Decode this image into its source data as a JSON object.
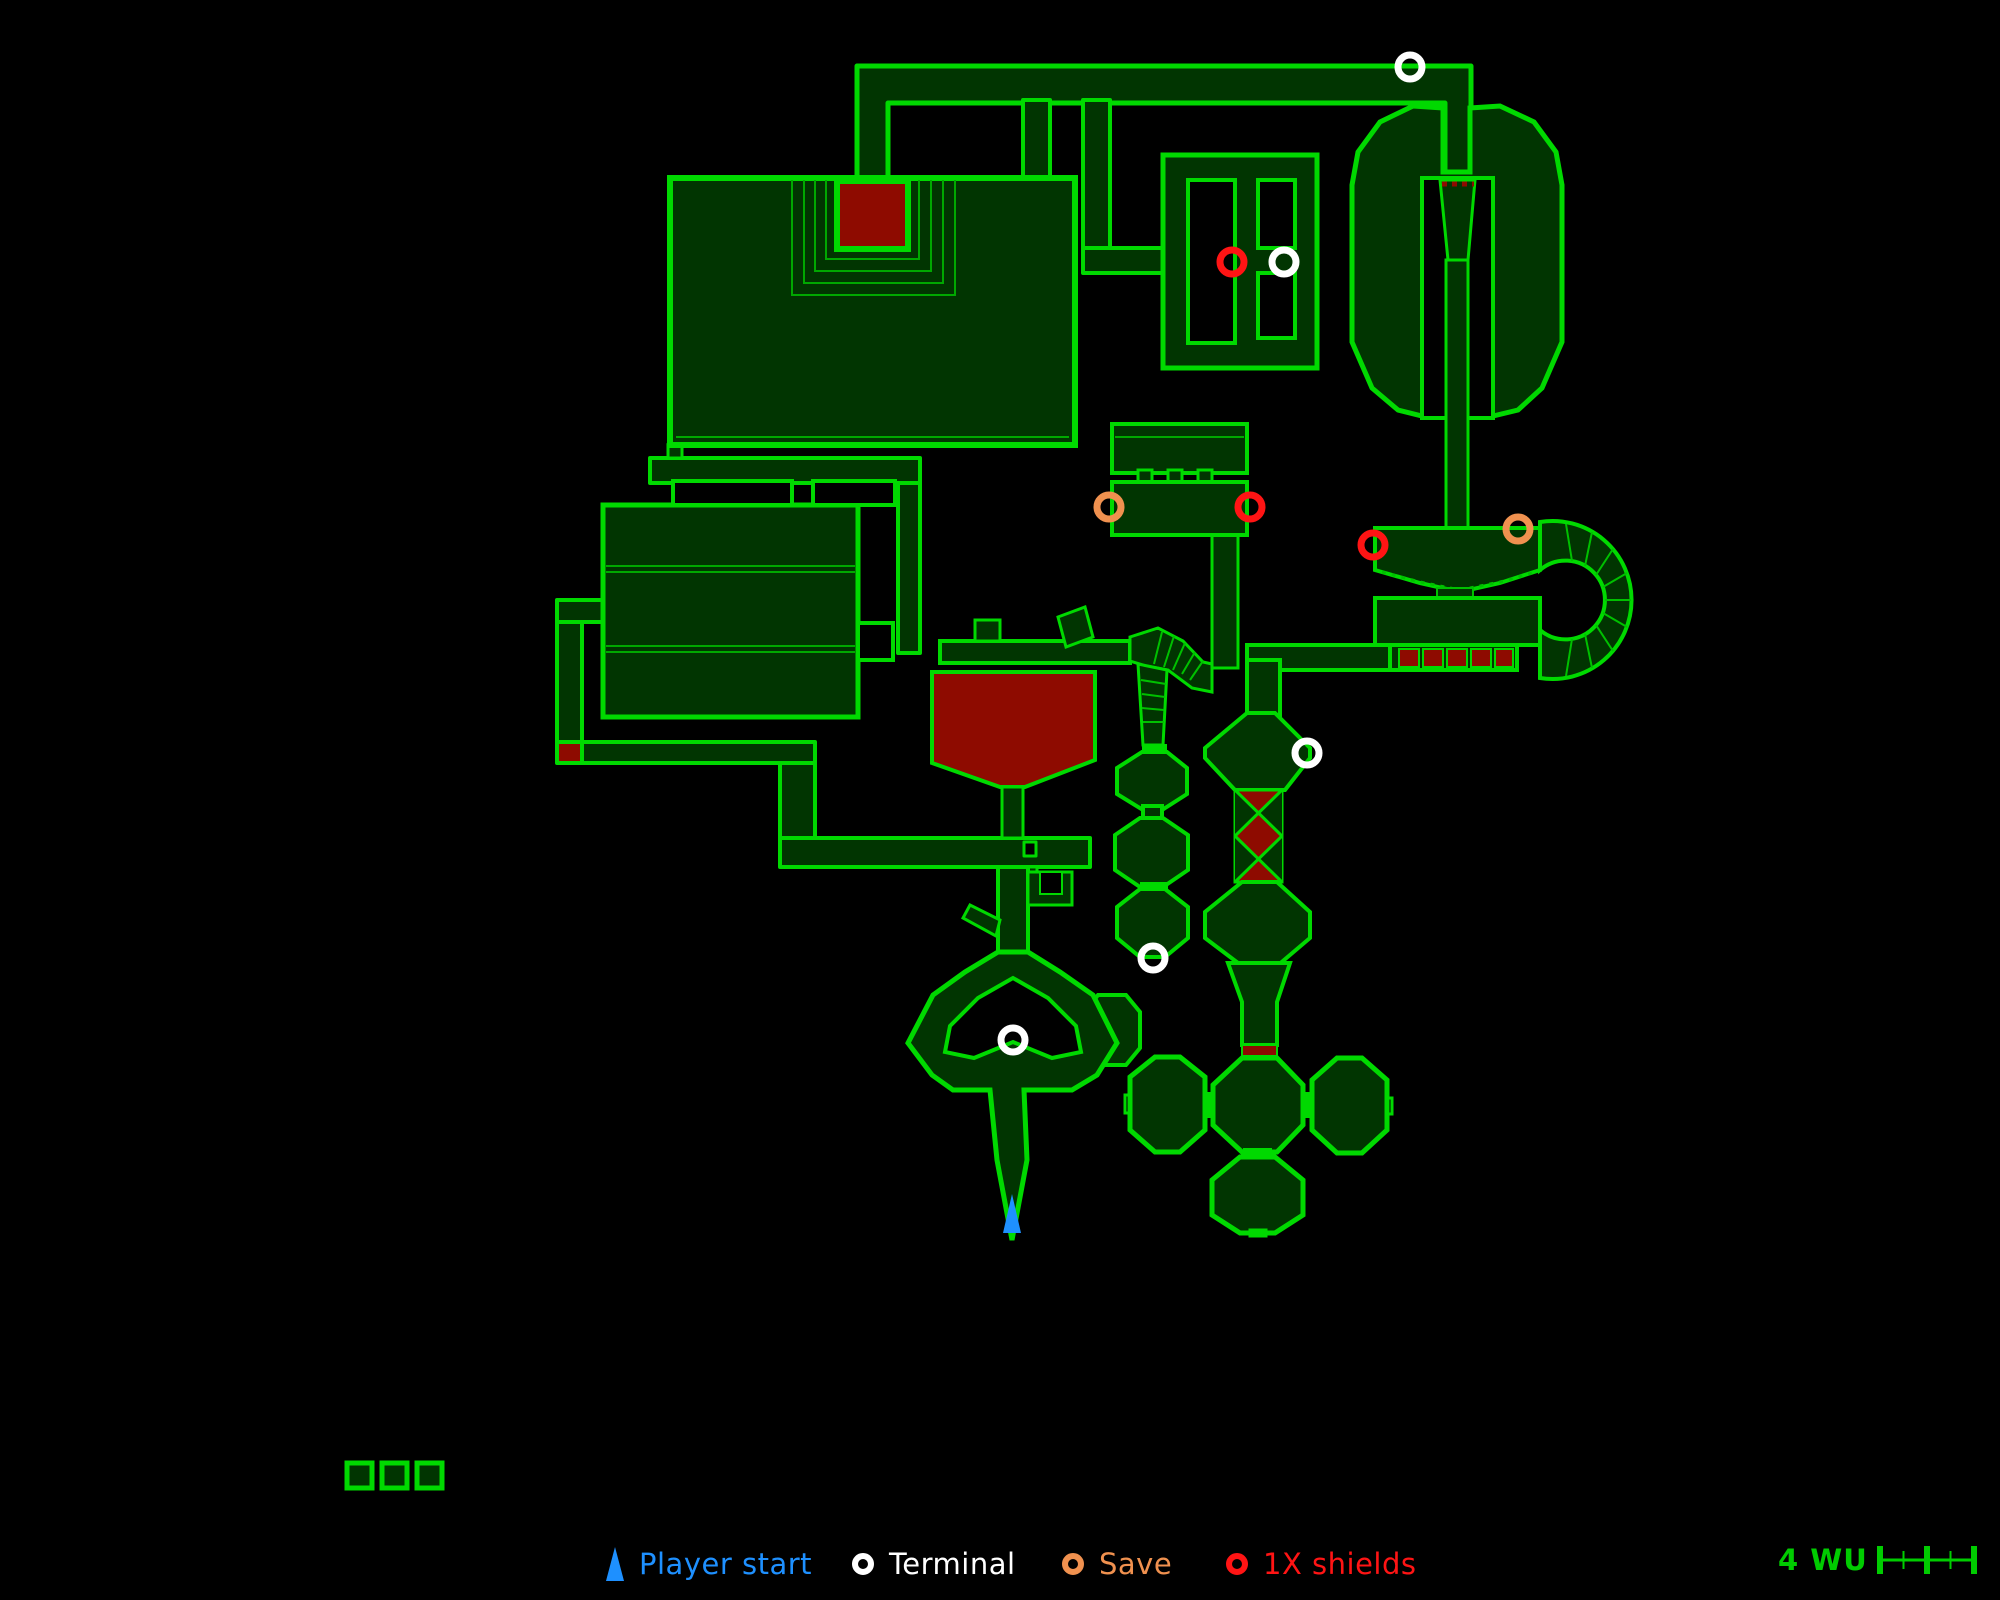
{
  "legend": {
    "items": [
      {
        "id": "player-start",
        "label": "Player start",
        "color": "#1e90ff",
        "glyph": "triangle",
        "x": 606
      },
      {
        "id": "terminal",
        "label": "Terminal",
        "color": "#ffffff",
        "glyph": "ring",
        "x": 852
      },
      {
        "id": "save",
        "label": "Save",
        "color": "#f0914f",
        "glyph": "ring",
        "x": 1062
      },
      {
        "id": "shields",
        "label": "1X shields",
        "color": "#ff1414",
        "glyph": "ring",
        "x": 1226
      }
    ],
    "scale": {
      "label": "4 WU",
      "units": 4
    }
  },
  "map": {
    "colors": {
      "wall": "#00d900",
      "wall_dim": "#00a800",
      "floor": "#013501",
      "hazard": "#8e0b00",
      "background": "#000000",
      "terminal": "#ffffff",
      "save": "#f0914f",
      "shield": "#ff1414",
      "player": "#1e90ff"
    },
    "markers": {
      "player_start": {
        "x": 1012,
        "y": 1214
      },
      "terminals": [
        [
          1410,
          67
        ],
        [
          1284,
          262
        ],
        [
          1307,
          753
        ],
        [
          1153,
          958
        ],
        [
          1013,
          1040
        ]
      ],
      "saves": [
        [
          1109,
          507
        ],
        [
          1518,
          529
        ]
      ],
      "shields": [
        [
          1232,
          262
        ],
        [
          1250,
          507
        ],
        [
          1373,
          545
        ]
      ]
    },
    "detached_rooms": {
      "count": 3,
      "x": 347,
      "y": 1463,
      "size": 25,
      "gap": 35
    }
  }
}
